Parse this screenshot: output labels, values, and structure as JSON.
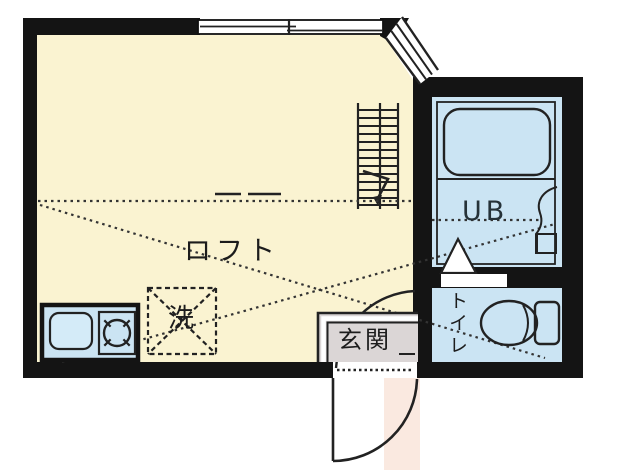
{
  "title": "apartment-floor-plan",
  "labels": {
    "loft": "ロフト",
    "washer": "洗",
    "unit_bath": "UB",
    "entrance": "玄関",
    "toilet": "トイレ"
  },
  "colors": {
    "wall": "#141414",
    "room_floor": "#FAF3D1",
    "wet_floor": "#CBE4F3",
    "fixture_fill": "#D4EBF8",
    "entrance_floor": "#DBD6D6",
    "outside_step": "#FAE9E0",
    "white": "#FFFFFF"
  },
  "fixtures": [
    "bathtub",
    "wash-basin",
    "toilet-bowl",
    "toilet-tank",
    "kitchen-sink",
    "stove-burner",
    "washing-machine",
    "stairs-ladder",
    "entrance-door",
    "ub-folding-door",
    "sliding-window",
    "corner-window",
    "loft-outline"
  ]
}
